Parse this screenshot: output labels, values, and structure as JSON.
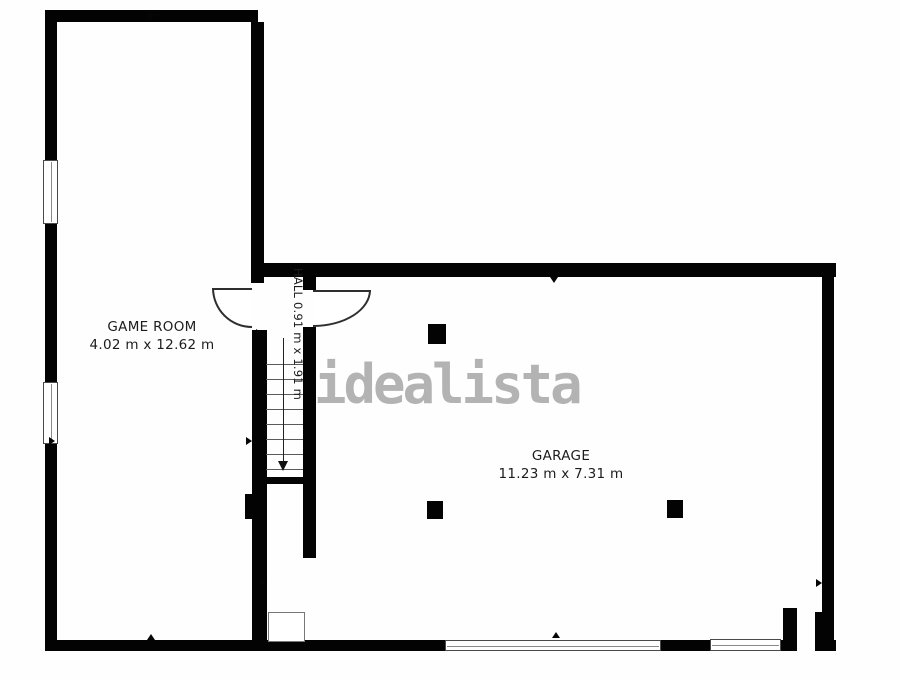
{
  "watermark": {
    "text": "idealista",
    "color": "#b3b3b3"
  },
  "rooms": {
    "game_room": {
      "label": "GAME ROOM",
      "dimensions": "4.02 m x 12.62 m"
    },
    "hall": {
      "label": "HALL",
      "dimensions": "0.91 m x 1.91 m"
    },
    "garage": {
      "label": "GARAGE",
      "dimensions": "11.23 m x 7.31 m"
    }
  },
  "colors": {
    "wall": "#030303",
    "label_text": "#1c1c1c",
    "watermark": "#b3b3b3",
    "background": "#fefefe"
  }
}
